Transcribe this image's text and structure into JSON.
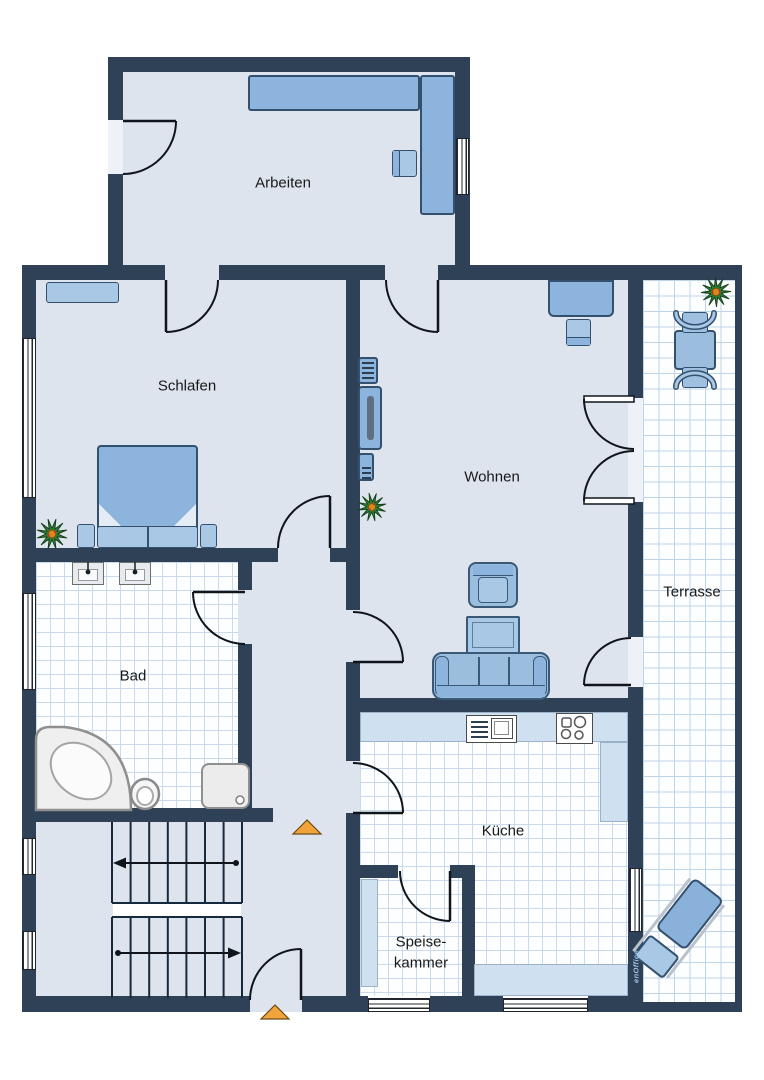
{
  "labels": {
    "arbeiten": "Arbeiten",
    "schlafen": "Schlafen",
    "wohnen": "Wohnen",
    "bad": "Bad",
    "kueche": "Küche",
    "speisekammer_line1": "Speise-",
    "speisekammer_line2": "kammer",
    "terrasse": "Terrasse"
  },
  "watermark": "enOffice",
  "colors": {
    "wall": "#2e4156",
    "floor": "#dde4ee",
    "furniture_blue": "#8db4dc",
    "furniture_light": "#a9c8e6",
    "counter": "#cfe0f0",
    "tile_line": "#c9daec",
    "marker_orange": "#f2a43c",
    "plant_green": "#2f7c35"
  }
}
